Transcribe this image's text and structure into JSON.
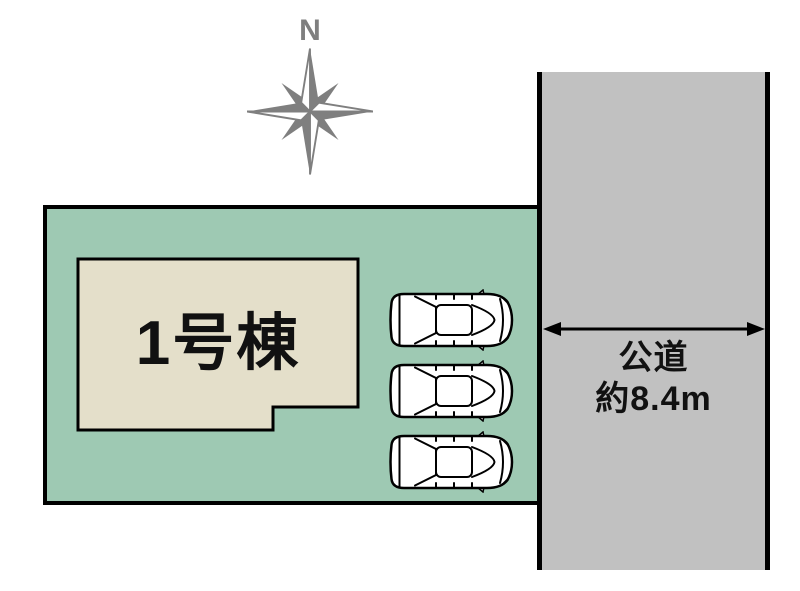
{
  "compass": {
    "north_label": "N"
  },
  "site": {
    "building": {
      "label": "1号棟"
    },
    "parking": {
      "car_count": 3
    }
  },
  "road": {
    "name": "公道",
    "width_label": "約8.4m"
  },
  "colors": {
    "plot_fill": "#9ec9b3",
    "building_fill": "#e4dfca",
    "road_fill": "#c1c1c1",
    "compass_gray": "#7f7f7f",
    "line_black": "#000000",
    "text_black": "#111111"
  }
}
